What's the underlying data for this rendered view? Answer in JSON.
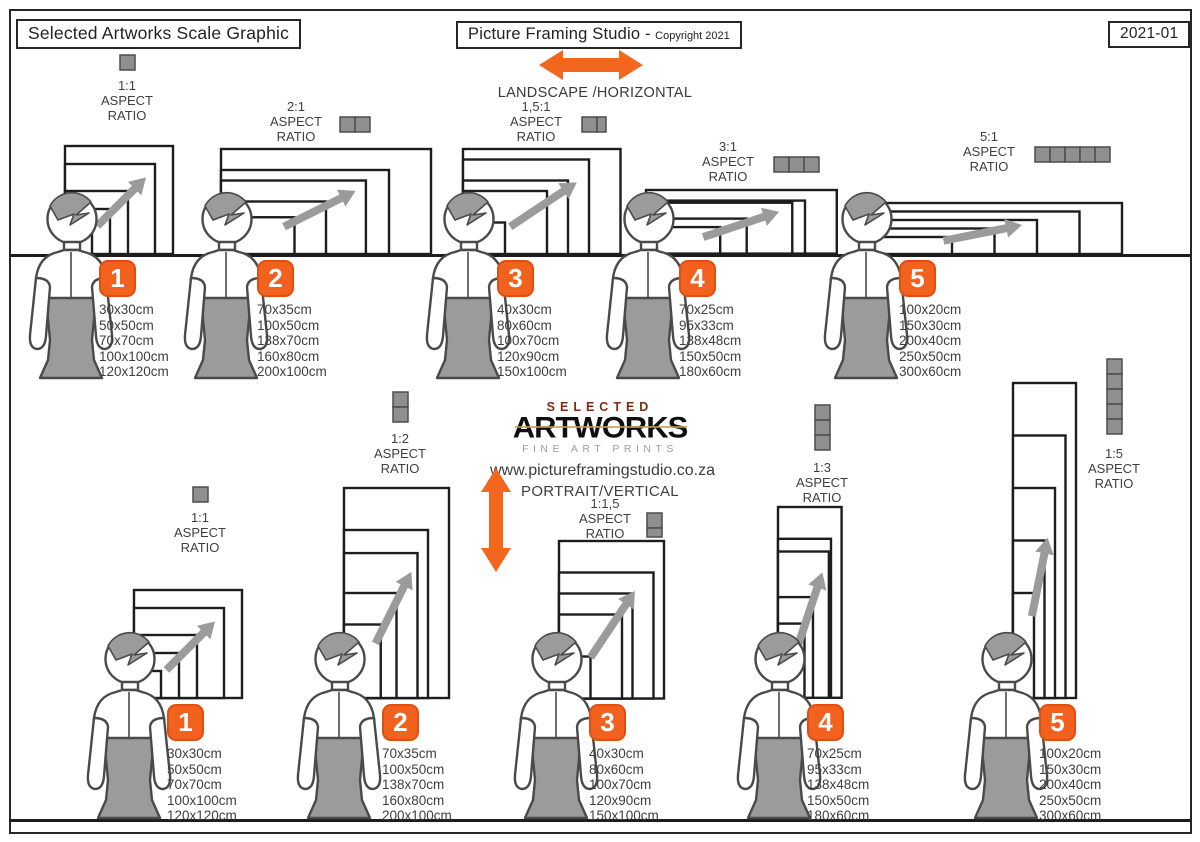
{
  "header": {
    "left_title": "Selected Artworks Scale Graphic",
    "center_title": "Picture Framing Studio -",
    "center_subtitle": "Copyright 2021",
    "doc_number": "2021-01"
  },
  "orientation_labels": {
    "landscape": "LANDSCAPE /HORIZONTAL",
    "portrait": "PORTRAIT/VERTICAL"
  },
  "logo": {
    "line1": "SELECTED",
    "line2": "ARTWORKS",
    "line3": "FINE ART PRINTS",
    "website": "www.pictureframingstudio.co.za"
  },
  "aspect_words": {
    "aspect": "ASPECT",
    "ratio": "RATIO"
  },
  "groups": {
    "landscape": [
      {
        "num": "1",
        "ratio": "1:1",
        "sizes": [
          "30x30cm",
          "50x50cm",
          "70x70cm",
          "100x100cm",
          "120x120cm"
        ]
      },
      {
        "num": "2",
        "ratio": "2:1",
        "sizes": [
          "70x35cm",
          "100x50cm",
          "138x70cm",
          "160x80cm",
          "200x100cm"
        ]
      },
      {
        "num": "3",
        "ratio": "1,5:1",
        "sizes": [
          "40x30cm",
          "80x60cm",
          "100x70cm",
          "120x90cm",
          "150x100cm"
        ]
      },
      {
        "num": "4",
        "ratio": "3:1",
        "sizes": [
          "70x25cm",
          "95x33cm",
          "138x48cm",
          "150x50cm",
          "180x60cm"
        ]
      },
      {
        "num": "5",
        "ratio": "5:1",
        "sizes": [
          "100x20cm",
          "150x30cm",
          "200x40cm",
          "250x50cm",
          "300x60cm"
        ]
      }
    ],
    "portrait": [
      {
        "num": "1",
        "ratio": "1:1",
        "sizes": [
          "30x30cm",
          "50x50cm",
          "70x70cm",
          "100x100cm",
          "120x120cm"
        ]
      },
      {
        "num": "2",
        "ratio": "1:2",
        "sizes": [
          "70x35cm",
          "100x50cm",
          "138x70cm",
          "160x80cm",
          "200x100cm"
        ]
      },
      {
        "num": "3",
        "ratio": "1:1,5",
        "sizes": [
          "40x30cm",
          "80x60cm",
          "100x70cm",
          "120x90cm",
          "150x100cm"
        ]
      },
      {
        "num": "4",
        "ratio": "1:3",
        "sizes": [
          "70x25cm",
          "95x33cm",
          "138x48cm",
          "150x50cm",
          "180x60cm"
        ]
      },
      {
        "num": "5",
        "ratio": "1:5",
        "sizes": [
          "100x20cm",
          "150x30cm",
          "200x40cm",
          "250x50cm",
          "300x60cm"
        ]
      }
    ]
  },
  "colors": {
    "accent_orange": "#F2611E",
    "frame_stroke": "#1d1d1d",
    "figure_gray": "#9b9b9b",
    "text_dark": "#3c3c3c"
  }
}
